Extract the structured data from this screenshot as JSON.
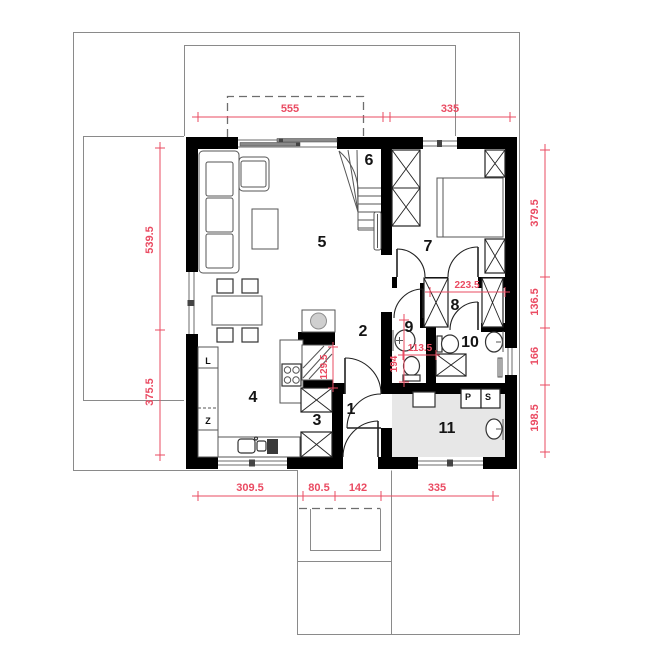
{
  "plan": {
    "rooms": {
      "r1": "1",
      "r2": "2",
      "r3": "3",
      "r4": "4",
      "r5": "5",
      "r6": "6",
      "r7": "7",
      "r8": "8",
      "r9": "9",
      "r10": "10",
      "r11": "11"
    },
    "dims": {
      "top_left": "555",
      "top_right": "335",
      "left_upper": "539.5",
      "left_lower": "375.5",
      "right_1": "379.5",
      "right_2": "136.5",
      "right_3": "166",
      "right_4": "198.5",
      "bottom_1": "309.5",
      "bottom_2": "80.5",
      "bottom_3": "142",
      "bottom_4": "335",
      "hall_width": "223.5",
      "wc_width": "113.5",
      "wc_height": "194",
      "pantry_height": "129.5"
    },
    "appliances": {
      "fridge": "L",
      "dishwasher": "Z",
      "washer": "P",
      "dryer": "S"
    },
    "colors": {
      "dimension": "#ea4b62",
      "wall": "#000000",
      "outline": "#8a8a8a",
      "utility_floor": "#e7e7e7"
    }
  }
}
